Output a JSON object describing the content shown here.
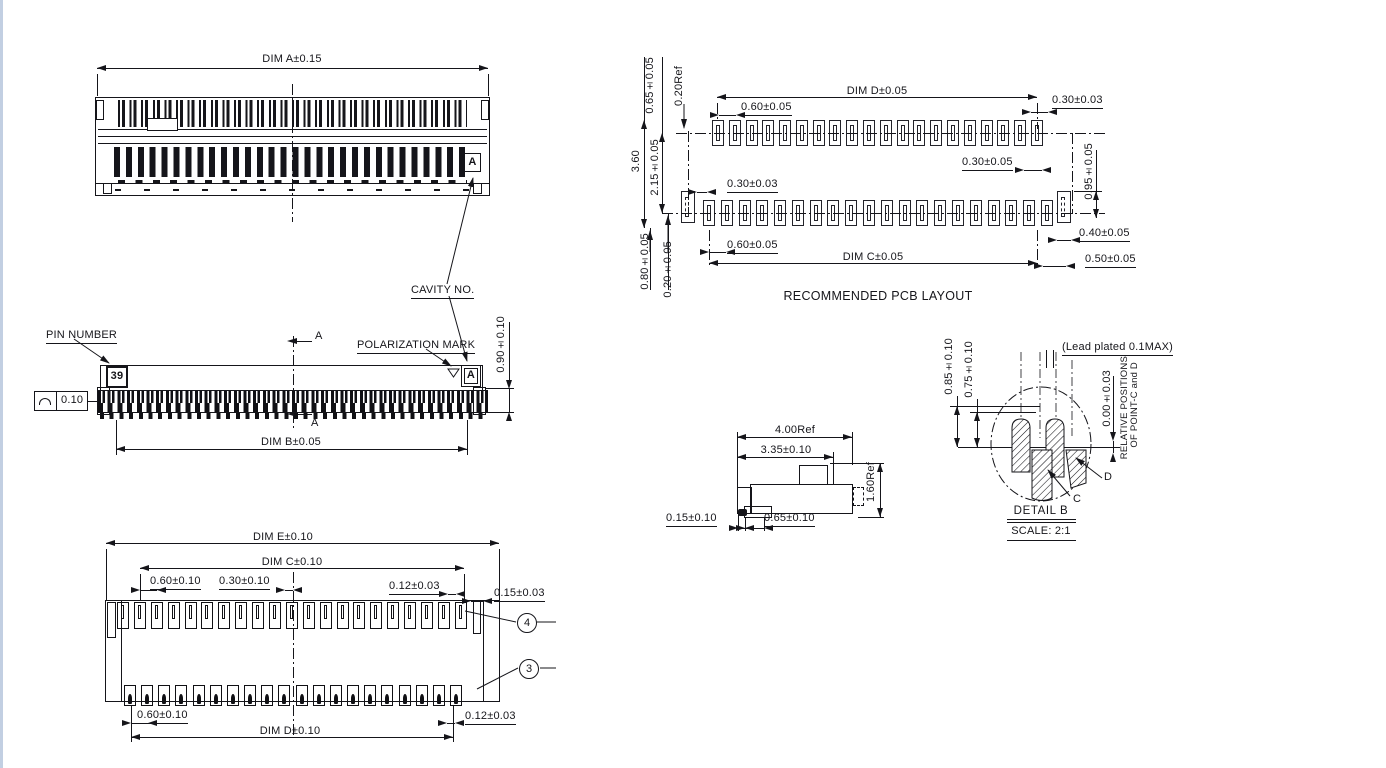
{
  "top_view": {
    "dim_a": "DIM A±0.15",
    "cavity_marker": "A"
  },
  "front_view": {
    "pin_number_label": "PIN NUMBER",
    "pin_number": "39",
    "polarization_label": "POLARIZATION MARK",
    "cavity_no_label": "CAVITY NO.",
    "cavity_marker": "A",
    "section_label_top": "A",
    "section_label_bottom": "A",
    "height_dim": "0.90±0.10",
    "dim_b": "DIM B±0.05",
    "profile_tol": "0.10"
  },
  "bottom_view": {
    "dim_e": "DIM E±0.10",
    "dim_c": "DIM C±0.10",
    "pitch_top": "0.60±0.10",
    "offset_top": "0.30±0.10",
    "tab_top": "0.12±0.03",
    "edge_gap": "0.15±0.03",
    "balloon_4": "4",
    "balloon_3": "3",
    "pitch_bottom": "0.60±0.10",
    "tab_bottom": "0.12±0.03",
    "dim_d": "DIM D±0.10"
  },
  "pcb_layout": {
    "title": "RECOMMENDED PCB LAYOUT",
    "dim_d": "DIM D±0.05",
    "dim_c": "DIM C±0.05",
    "pitch_top": "0.60±0.05",
    "pad_w_tr": "0.30±0.03",
    "offset_right": "0.30±0.05",
    "pad_w_left": "0.30±0.03",
    "pitch_bottom": "0.60±0.05",
    "col_h1": "0.65±0.05",
    "col_h2": "0.20Ref",
    "col_h3": "3.60",
    "col_h4": "2.15±0.05",
    "col_h5": "0.80±0.05",
    "col_h6": "0.20±0.05",
    "row_right": "0.95±0.05",
    "end_pad_w": "0.40±0.05",
    "end_pad_off": "0.50±0.05"
  },
  "section_view": {
    "width_ref": "4.00Ref",
    "width": "3.35±0.10",
    "height_ref": "1.60Ref",
    "lip": "0.15±0.10",
    "depth": "0.65±0.10"
  },
  "detail_b": {
    "lead_note": "(Lead plated 0.1MAX)",
    "h1": "0.85±0.10",
    "h2": "0.75±0.10",
    "zero": "0.00±0.03",
    "rel_note_1": "RELATIVE POSITIONS",
    "rel_note_2": "OF POINT-C and D",
    "point_c": "C",
    "point_d": "D",
    "title": "DETAIL B",
    "scale": "SCALE: 2:1"
  }
}
